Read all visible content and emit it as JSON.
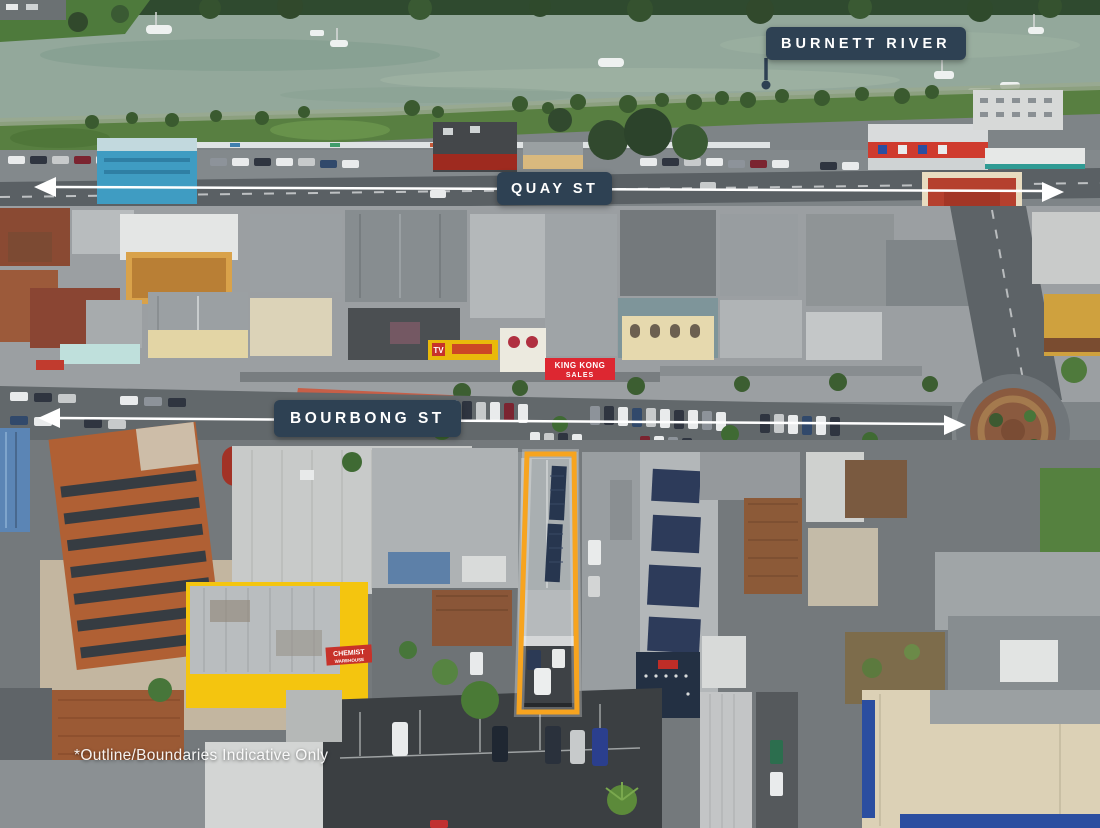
{
  "labels": {
    "river": "BURNETT RIVER",
    "street_quay": "QUAY ST",
    "street_bourbong": "BOURBONG ST",
    "disclaimer": "*Outline/Boundaries Indicative Only"
  },
  "signs": {
    "chemist_line1": "CHEMIST",
    "chemist_line2": "WAREHOUSE",
    "kingkong_line1": "KING KONG",
    "kingkong_line2": "SALES",
    "tv": "TV"
  },
  "colors": {
    "label_background": "#2E4153",
    "label_text": "#FFFFFF",
    "property_outline": "#F7A41F",
    "street_arrow": "#FFFFFF"
  }
}
